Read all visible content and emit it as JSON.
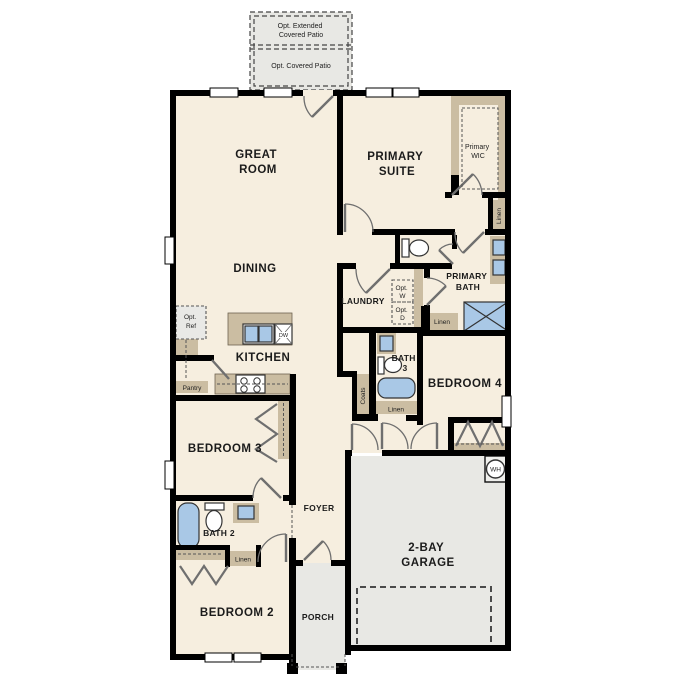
{
  "floor_plan": {
    "patio": {
      "extended_label": [
        "Opt. Extended",
        "Covered Patio"
      ],
      "covered_label": "Opt. Covered Patio"
    },
    "rooms": {
      "great_room": [
        "GREAT",
        "ROOM"
      ],
      "primary_suite": [
        "PRIMARY",
        "SUITE"
      ],
      "primary_wic": [
        "Primary",
        "WIC"
      ],
      "dining": "DINING",
      "laundry": "LAUNDRY",
      "primary_bath": [
        "PRIMARY",
        "BATH"
      ],
      "kitchen": "KITCHEN",
      "bath_3": [
        "BATH",
        "3"
      ],
      "bedroom_4": "BEDROOM 4",
      "bedroom_3": "BEDROOM 3",
      "foyer": "FOYER",
      "bath_2": "BATH 2",
      "bedroom_2": "BEDROOM 2",
      "porch": "PORCH",
      "garage": [
        "2-BAY",
        "GARAGE"
      ]
    },
    "closets": {
      "linen": "Linen",
      "coats": "Coats",
      "pantry": "Pantry"
    },
    "appliances": {
      "opt_ref": [
        "Opt.",
        "Ref"
      ],
      "opt_washer": [
        "Opt.",
        "W"
      ],
      "opt_dryer": [
        "Opt.",
        "D"
      ],
      "dishwasher": "DW",
      "water_heater": "WH"
    },
    "colors": {
      "wall": "#000000",
      "room_fill": "#f6eedf",
      "concrete_fill": "#e8e8e4",
      "cabinet_fill": "#cbbda2",
      "fixture_fill": "#a9c8e6",
      "door": "#6f6f6f"
    }
  }
}
